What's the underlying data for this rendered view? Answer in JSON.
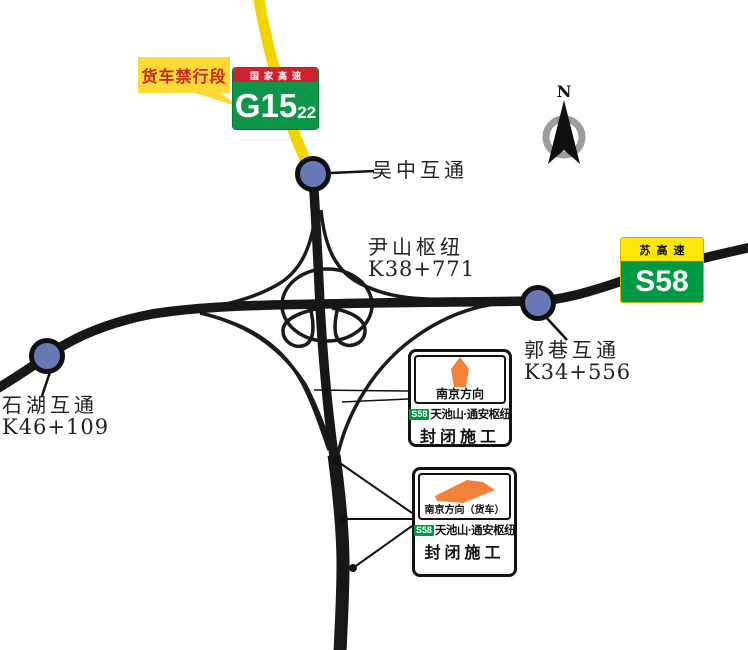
{
  "compass": {
    "north_label": "N"
  },
  "g15_sign": {
    "top_label": "国家高速",
    "code": "G15",
    "code_suffix": "22"
  },
  "s58_sign": {
    "top_label": "苏高速",
    "code": "S58"
  },
  "truck_ban_callout": {
    "label": "货车禁行段"
  },
  "interchanges": {
    "wuzhong": {
      "name": "吴中互通"
    },
    "yinshan": {
      "name": "尹山枢纽",
      "chainage": "K38+771"
    },
    "guoxiang": {
      "name": "郭巷互通",
      "chainage": "K34+556"
    },
    "shihu": {
      "name": "石湖互通",
      "chainage": "K46+109"
    }
  },
  "closure_notices": [
    {
      "direction": "南京方向",
      "arrow_icon": "up-arrow-icon",
      "badge": "S58",
      "junction": "天池山·通安枢纽",
      "status": "封闭施工"
    },
    {
      "direction": "南京方向（货车）",
      "arrow_icon": "right-arrow-icon",
      "badge": "S58",
      "junction": "天池山·通安枢纽",
      "status": "封闭施工"
    }
  ],
  "colors": {
    "road": "#1a1a1a",
    "g15_route_yellow": "#f2d400",
    "g15_green": "#0e9648",
    "g15_red": "#cf2230",
    "s58_green": "#009a44",
    "s58_yellow": "#ffe60a",
    "callout_yellow": "#ffd935",
    "callout_text_red": "#c5281c",
    "node_blue": "#6877b5",
    "notice_orange": "#f2813a"
  }
}
